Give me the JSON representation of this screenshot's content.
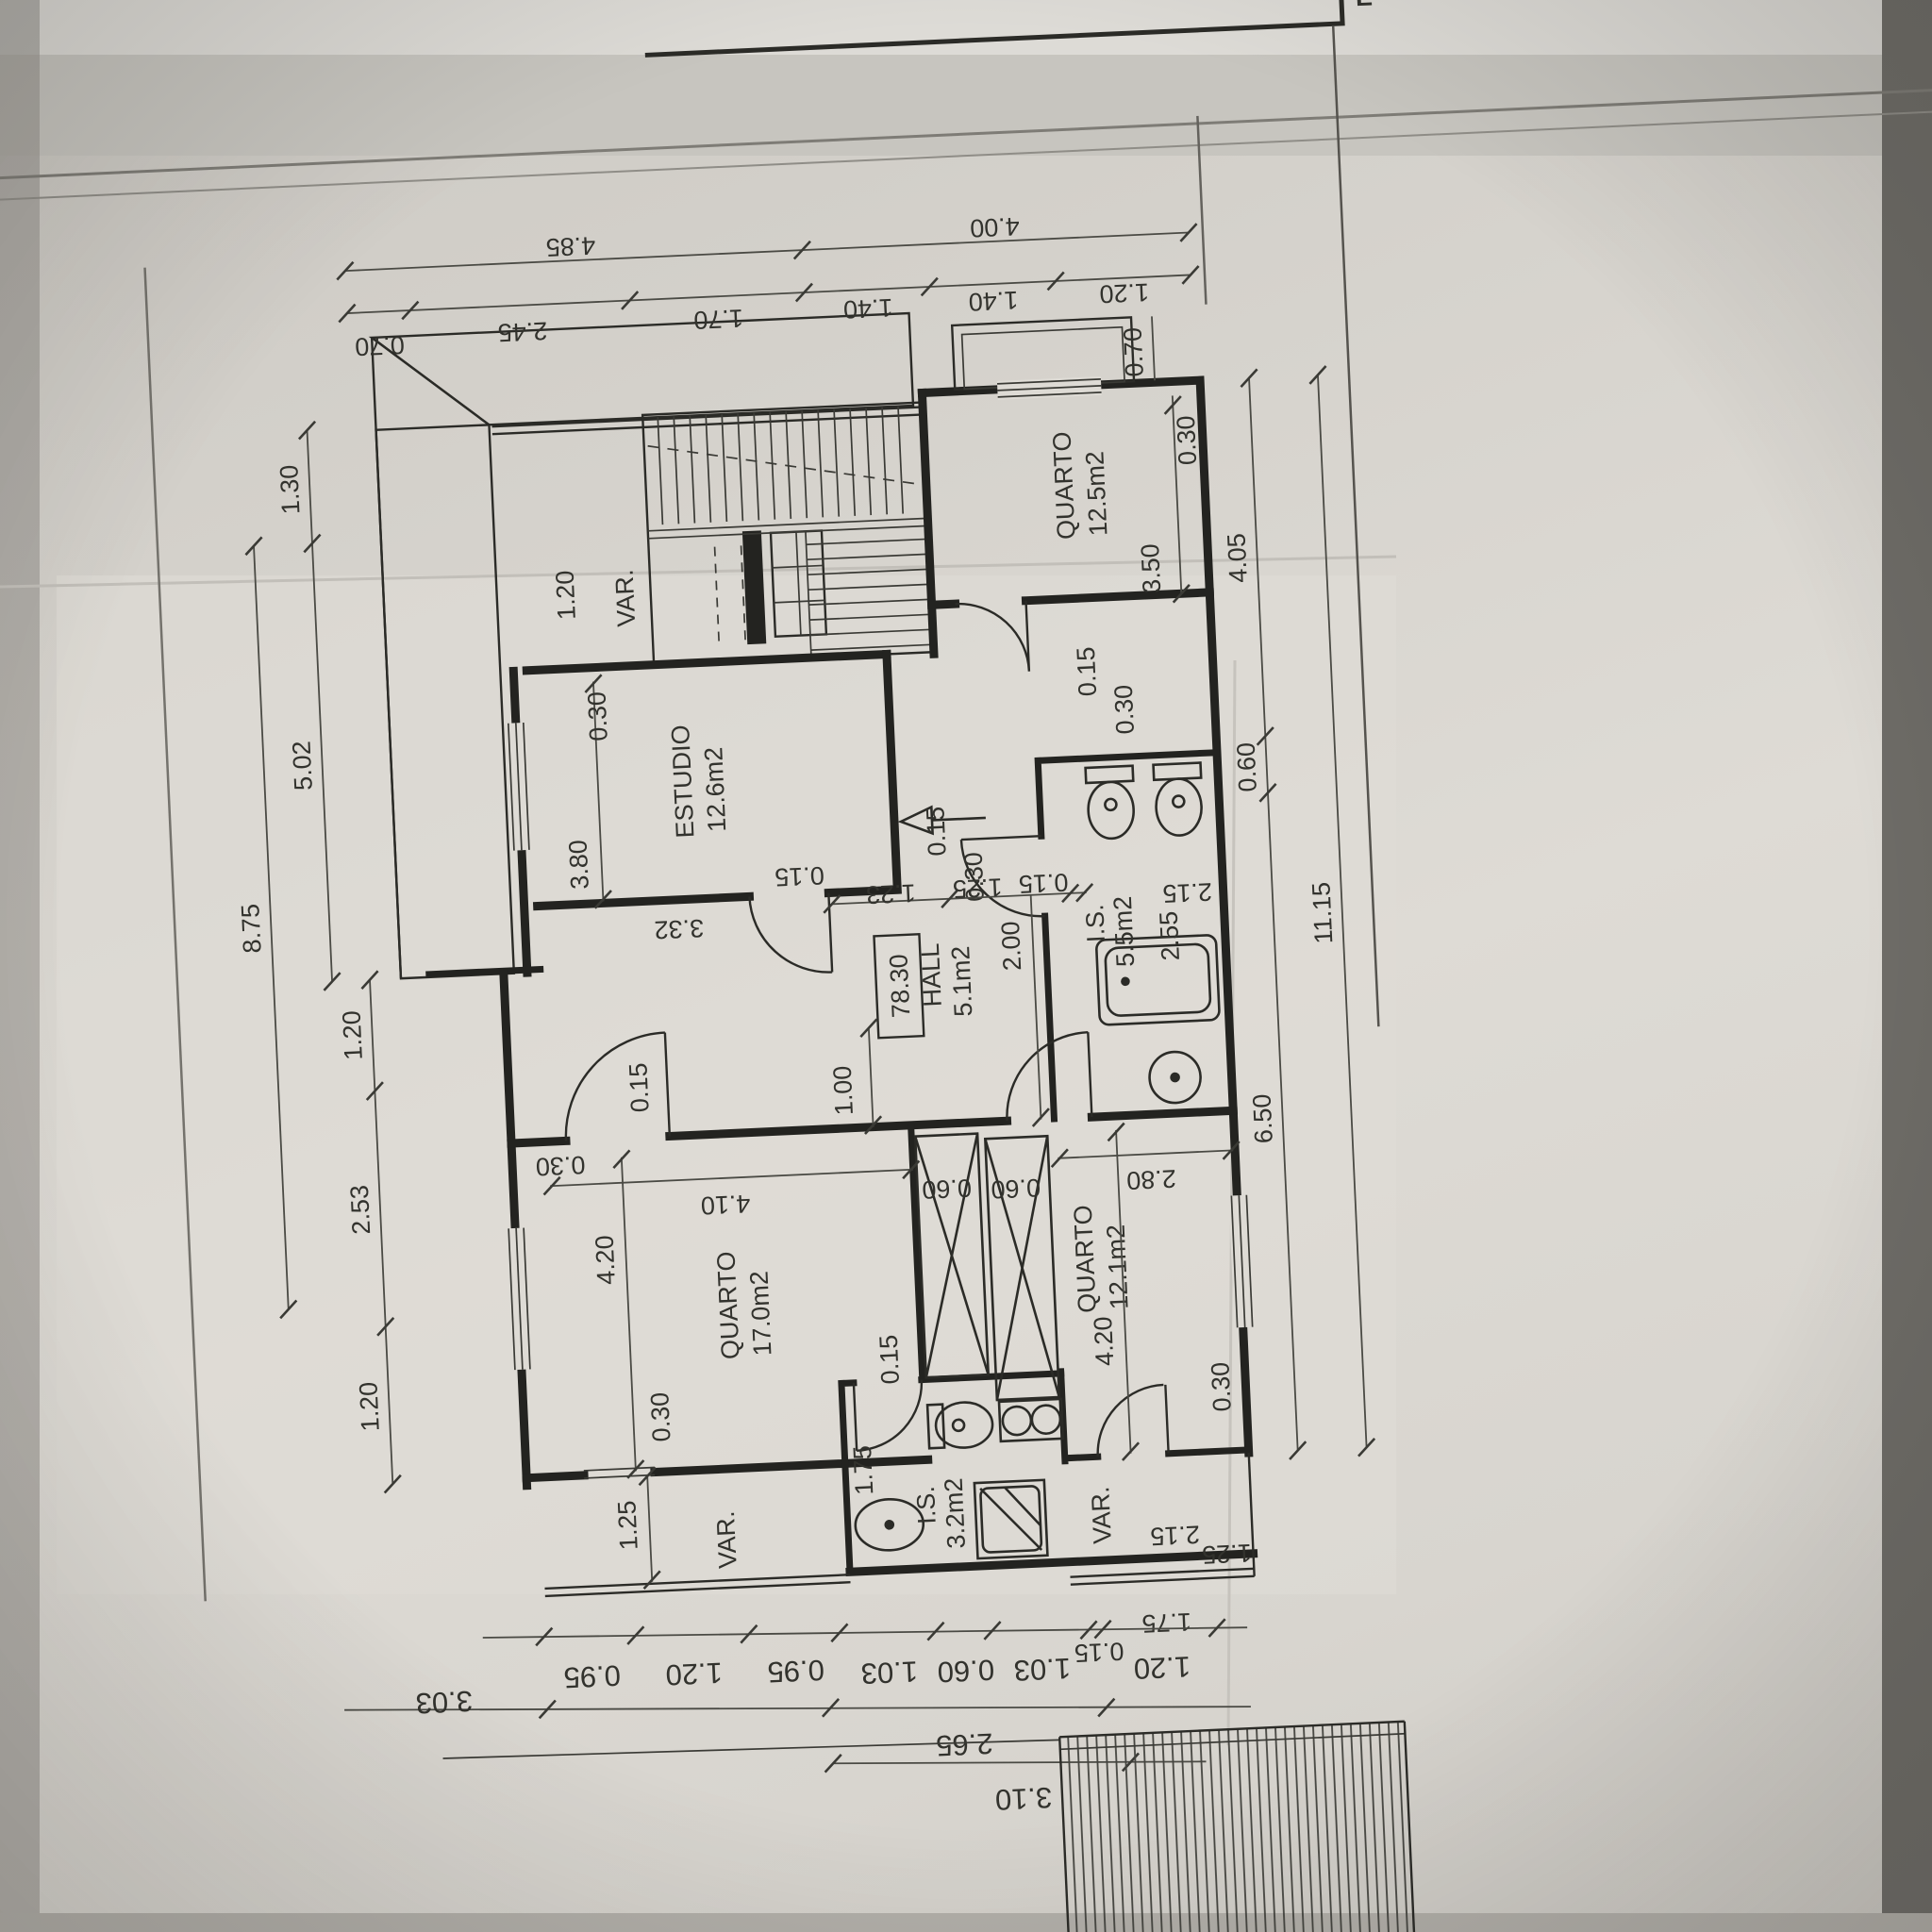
{
  "sheet": {
    "level_mark": "78.30",
    "edge_fragment": "E",
    "varanda_label": "VAR."
  },
  "rooms": [
    {
      "name": "QUARTO",
      "area": "12.5m2"
    },
    {
      "name": "ESTUDIO",
      "area": "12.6m2"
    },
    {
      "name": "HALL",
      "area": "5.1m2"
    },
    {
      "name": "I.S.",
      "area": "5.5m2"
    },
    {
      "name": "QUARTO",
      "area": "17.0m2"
    },
    {
      "name": "QUARTO",
      "area": "12.1m2"
    },
    {
      "name": "I.S.",
      "area": "3.2m2"
    }
  ],
  "dims": {
    "top_totals": [
      "4.85",
      "4.00"
    ],
    "top": [
      "0.70",
      "2.45",
      "1.70",
      "1.40",
      "1.40",
      "1.20"
    ],
    "left": [
      "1.30",
      "5.02",
      "8.75",
      "1.20",
      "2.53",
      "1.20"
    ],
    "right": [
      "0.70",
      "0.30",
      "3.50",
      "4.05",
      "0.60",
      "11.15",
      "6.50",
      "0.15",
      "0.30"
    ],
    "interior": [
      "1.20",
      "0.30",
      "3.80",
      "0.15",
      "3.32",
      "1.23",
      "1.25",
      "0.15",
      "2.00",
      "1.00",
      "2.15",
      "2.55",
      "0.30",
      "4.10",
      "4.20",
      "0.15",
      "0.60",
      "0.60",
      "0.15",
      "2.80",
      "4.20",
      "0.30",
      "1.75",
      "1.25",
      "0.30",
      "2.15",
      "1.25",
      "0.15",
      "0.30",
      "1.75"
    ],
    "bottom": [
      "0.95",
      "1.20",
      "0.95",
      "1.03",
      "0.60",
      "1.03",
      "0.15",
      "1.20"
    ],
    "bottom_totals": [
      "3.03",
      "2.65",
      "3.10"
    ]
  }
}
